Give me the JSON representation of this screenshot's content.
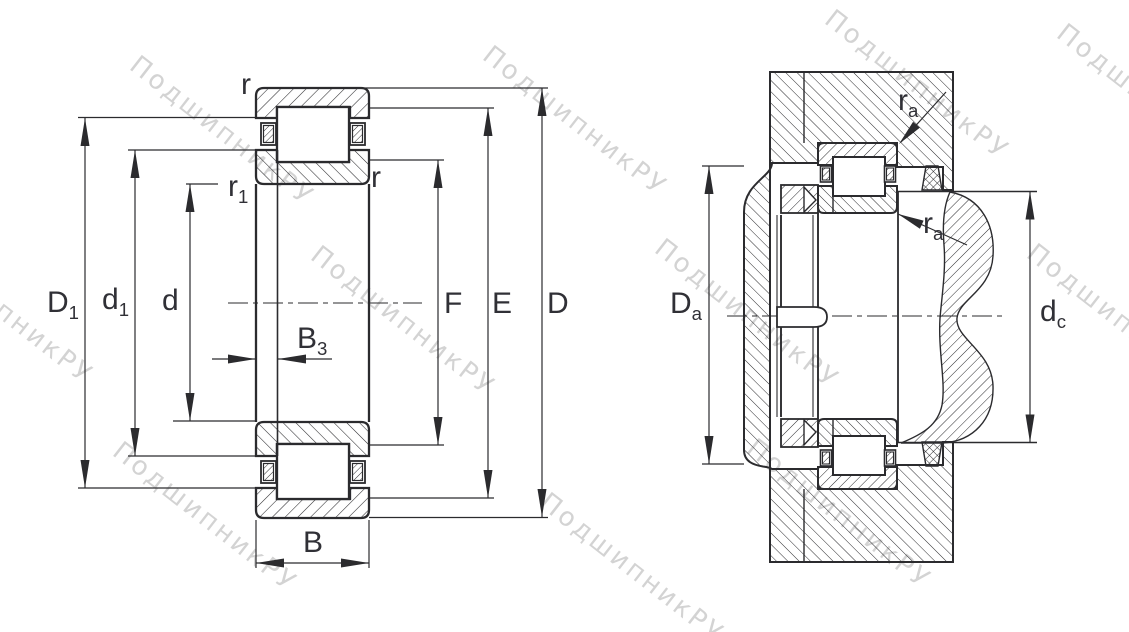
{
  "watermark": {
    "text": "ПодшипникРУ",
    "color": "#c9c9c9"
  },
  "colors": {
    "line": "#2b2b2e",
    "label": "#303036",
    "background": "#ffffff"
  },
  "left_diagram": {
    "description": "cylindrical-roller-bearing cross-section",
    "labels": {
      "D1": {
        "main": "D",
        "sub": "1"
      },
      "d1": {
        "main": "d",
        "sub": "1"
      },
      "d": {
        "main": "d",
        "sub": ""
      },
      "B3": {
        "main": "B",
        "sub": "3"
      },
      "B": {
        "main": "B",
        "sub": ""
      },
      "F": {
        "main": "F",
        "sub": ""
      },
      "E": {
        "main": "E",
        "sub": ""
      },
      "D": {
        "main": "D",
        "sub": ""
      },
      "r_top": {
        "main": "r",
        "sub": ""
      },
      "r1": {
        "main": "r",
        "sub": "1"
      },
      "r_inner": {
        "main": "r",
        "sub": ""
      }
    }
  },
  "right_diagram": {
    "description": "bearing mounting arrangement in housing with shaft",
    "labels": {
      "Da": {
        "main": "D",
        "sub": "a"
      },
      "dc": {
        "main": "d",
        "sub": "c"
      },
      "ra_top": {
        "main": "r",
        "sub": "a"
      },
      "ra_bottom": {
        "main": "r",
        "sub": "a"
      }
    }
  }
}
